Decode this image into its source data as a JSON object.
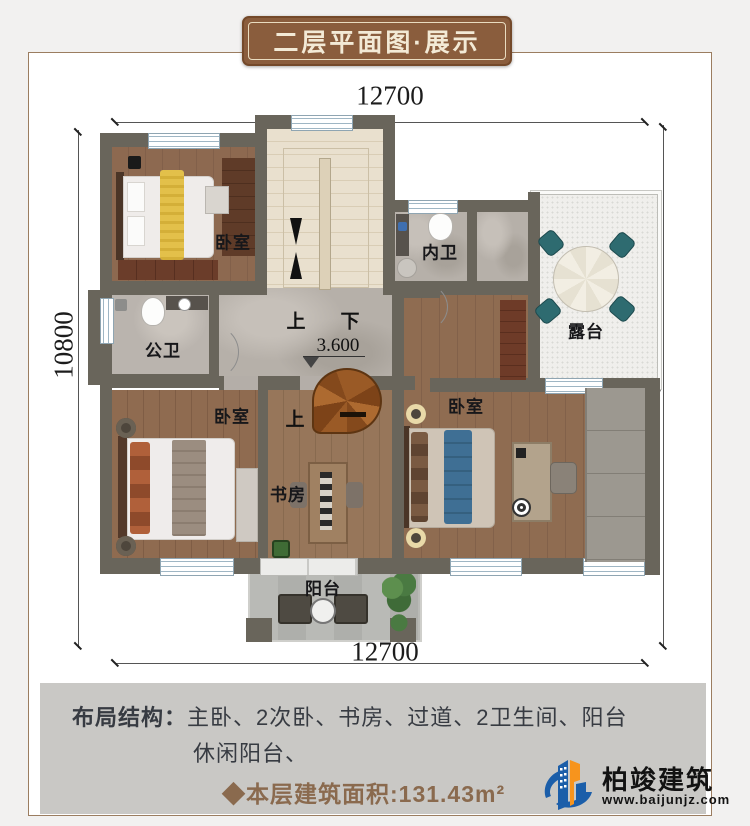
{
  "banner": {
    "title": "二层平面图·展示"
  },
  "dimensions": {
    "top": "12700",
    "bottom": "12700",
    "left": "10800",
    "right": "10800"
  },
  "plan": {
    "labels": {
      "bedroom_tl": "卧室",
      "bath_inner": "内卫",
      "terrace": "露台",
      "bath_public": "公卫",
      "bedroom_bl": "卧室",
      "study": "书房",
      "bedroom_master": "卧室",
      "balcony": "阳台",
      "stairs_up": "上",
      "stairs_down": "下",
      "stairs_up2": "上",
      "elevation": "3.600"
    }
  },
  "footer": {
    "layout_label": "布局结构：",
    "layout_line1": "主卧、2次卧、书房、过道、2卫生间、阳台",
    "layout_line2": "休闲阳台、",
    "area_text": "◆本层建筑面积:131.43m²",
    "brand_name": "柏竣建筑",
    "brand_site": "www.baijunjz.com"
  },
  "colors": {
    "banner_bg": "#8a5d3d",
    "banner_text": "#f3ead6",
    "wall": "#69655b",
    "area_text": "#8a6a4e",
    "footer_text": "#373b42",
    "logo_blue": "#1b5ea9",
    "logo_orange": "#f7941d"
  }
}
